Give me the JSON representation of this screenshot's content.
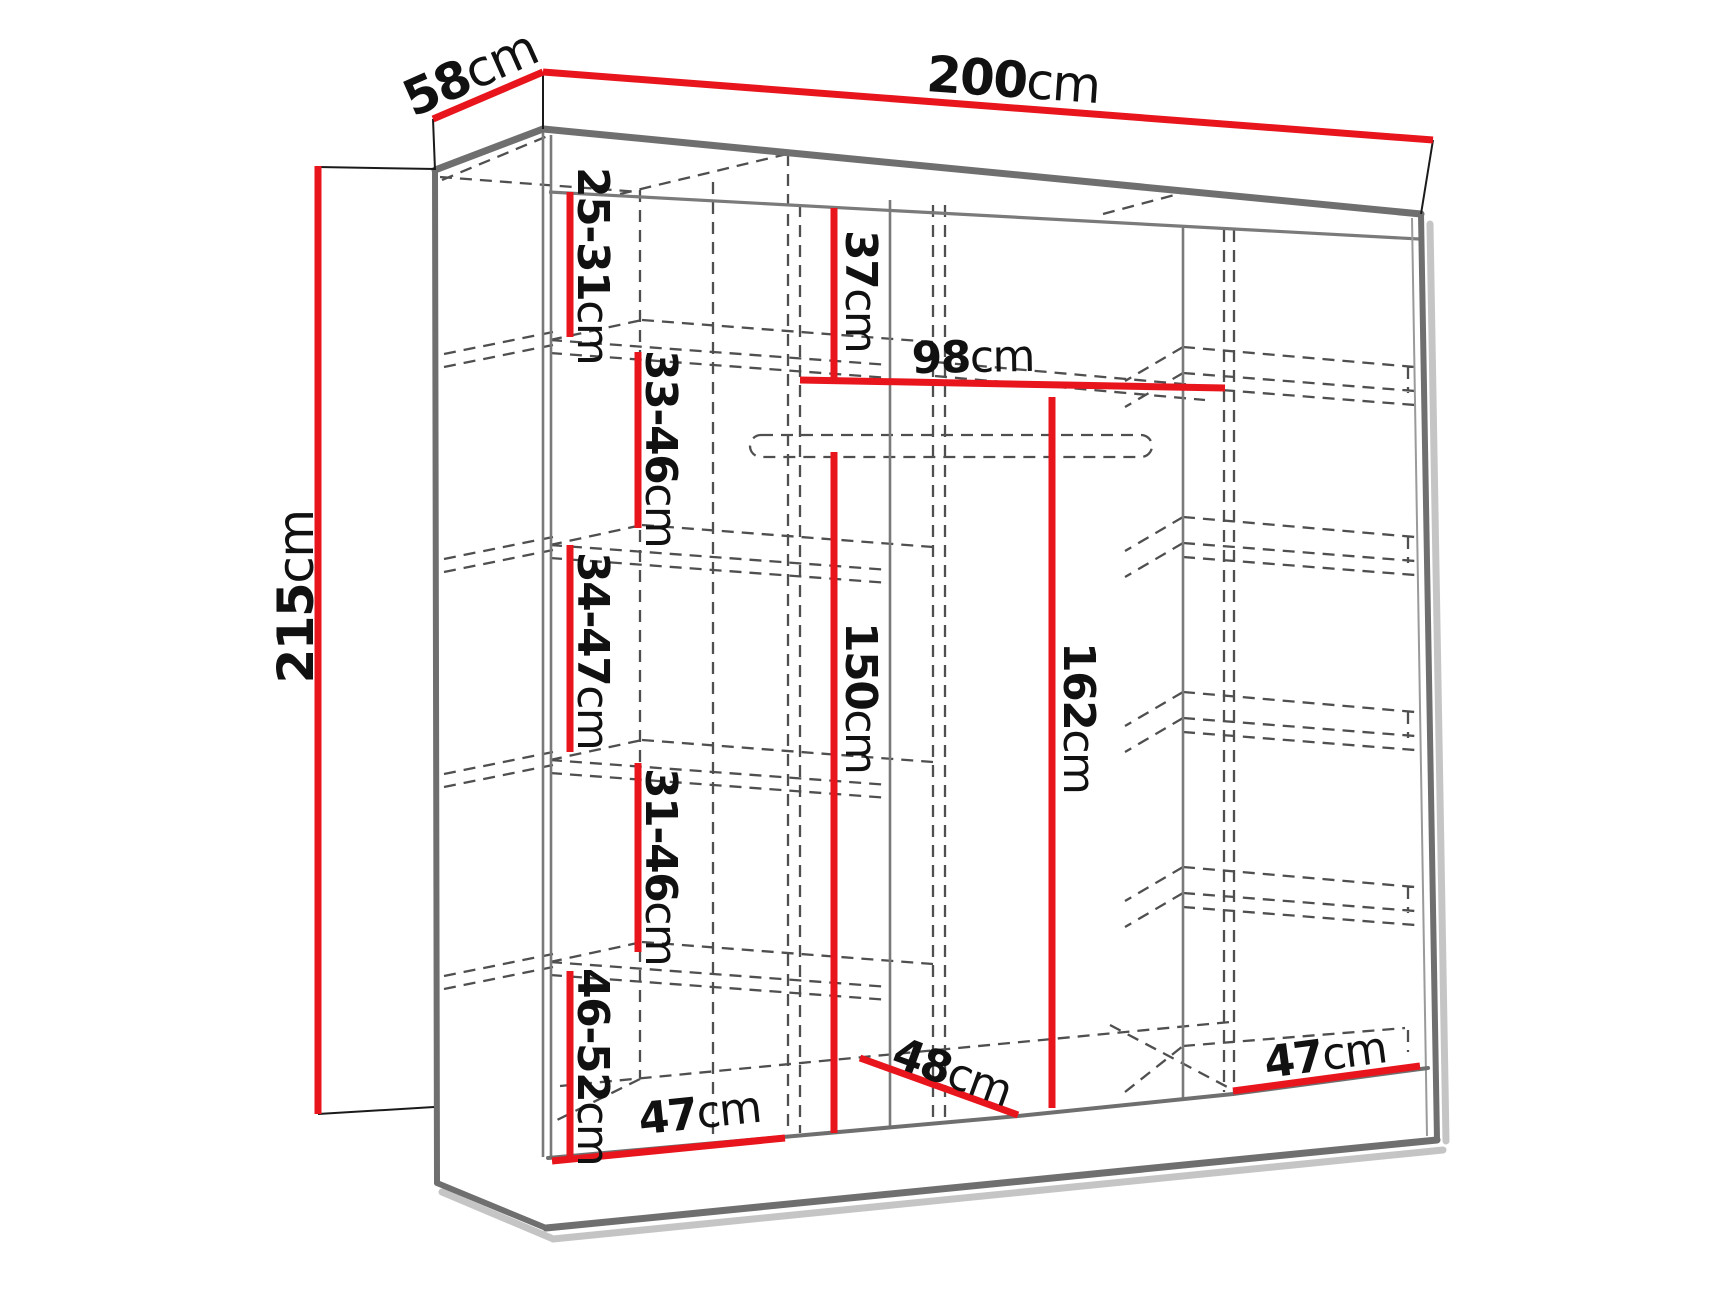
{
  "diagram": {
    "kind": "wardrobe-dimension-diagram",
    "unit": "cm",
    "style": "3d-line-drawing with red dimension lines and dashed hidden edges"
  },
  "colors": {
    "dimension_line": "#e8151d",
    "outline": "#6f6f6f",
    "interior_line": "#7a7a7a",
    "hidden_line": "#4f4f4f",
    "shadow": "#a6a6a6",
    "extension_line": "#1a1a1a",
    "label": "#111111",
    "background": "#ffffff"
  },
  "labels": {
    "width": {
      "num": "200",
      "unit": "cm"
    },
    "depth": {
      "num": "58",
      "unit": "cm"
    },
    "height": {
      "num": "215",
      "unit": "cm"
    },
    "left_gap_1": {
      "num": "25-31",
      "unit": "cm"
    },
    "left_gap_2": {
      "num": "33-46",
      "unit": "cm"
    },
    "left_gap_3": {
      "num": "34-47",
      "unit": "cm"
    },
    "left_gap_4": {
      "num": "31-46",
      "unit": "cm"
    },
    "left_gap_5": {
      "num": "46-52",
      "unit": "cm"
    },
    "top_shelf_height": {
      "num": "37",
      "unit": "cm"
    },
    "middle_width": {
      "num": "98",
      "unit": "cm"
    },
    "hanging_height_middle": {
      "num": "150",
      "unit": "cm"
    },
    "hanging_height_right": {
      "num": "162",
      "unit": "cm"
    },
    "floor_width_left": {
      "num": "47",
      "unit": "cm"
    },
    "floor_depth_middle": {
      "num": "48",
      "unit": "cm"
    },
    "floor_width_right": {
      "num": "47",
      "unit": "cm"
    }
  }
}
